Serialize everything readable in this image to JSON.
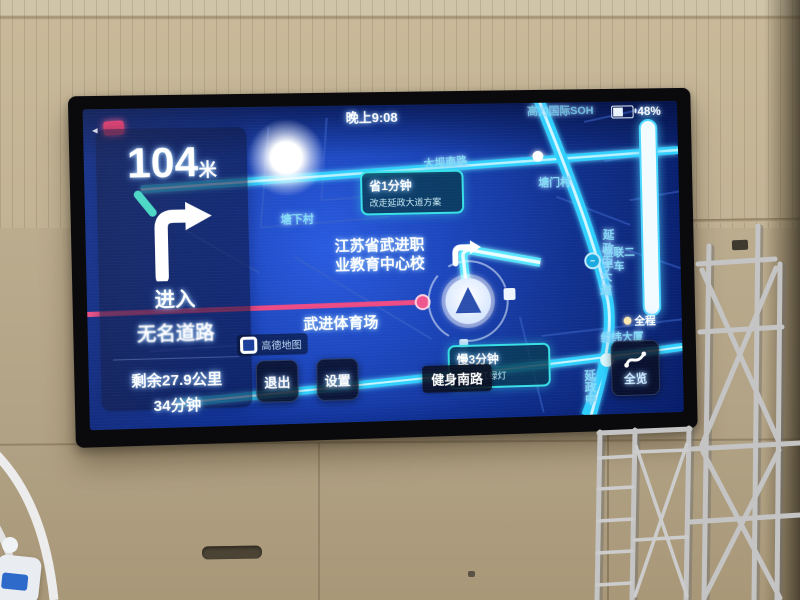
{
  "screen": {
    "status": {
      "time": "晚上9:08",
      "battery_percent": "48%"
    },
    "map": {
      "poi_top_right": "高力国际SOH",
      "village_north": "塘门村",
      "village_west": "塘下村",
      "school_line1": "江苏省武进职",
      "school_line2": "业教育中心校",
      "stadium": "武进体育场",
      "road_top": "大坝南路",
      "road_bottom": "健身南路",
      "road_vertical": "延政中大道",
      "road_vertical_south": "延政中",
      "poi_used_car_line1": "益联二",
      "poi_used_car_line2": "手车",
      "route_progress_label": "全程",
      "building": "经纬大厦",
      "bubble_alt_route": {
        "line1": "省1分钟",
        "line2": "改走延政大道方案"
      },
      "bubble_alt_route2": {
        "line1": "慢3分钟",
        "line2": "多3个红绿灯"
      },
      "watermark": "高德地图"
    },
    "nav_panel": {
      "distance_value": "104",
      "distance_unit": "米",
      "action": "进入",
      "road_name": "无名道路",
      "remaining_distance": "剩余27.9公里",
      "remaining_time": "34分钟"
    },
    "buttons": {
      "exit": "退出",
      "settings": "设置",
      "overview": "全览"
    }
  },
  "colors": {
    "map_background": "#1c46bc",
    "road_cyan": "#2fd0ff",
    "route_pink": "#ee4b84",
    "accent_cyan": "#49d6ff",
    "wall_tan": "#b3a384"
  }
}
